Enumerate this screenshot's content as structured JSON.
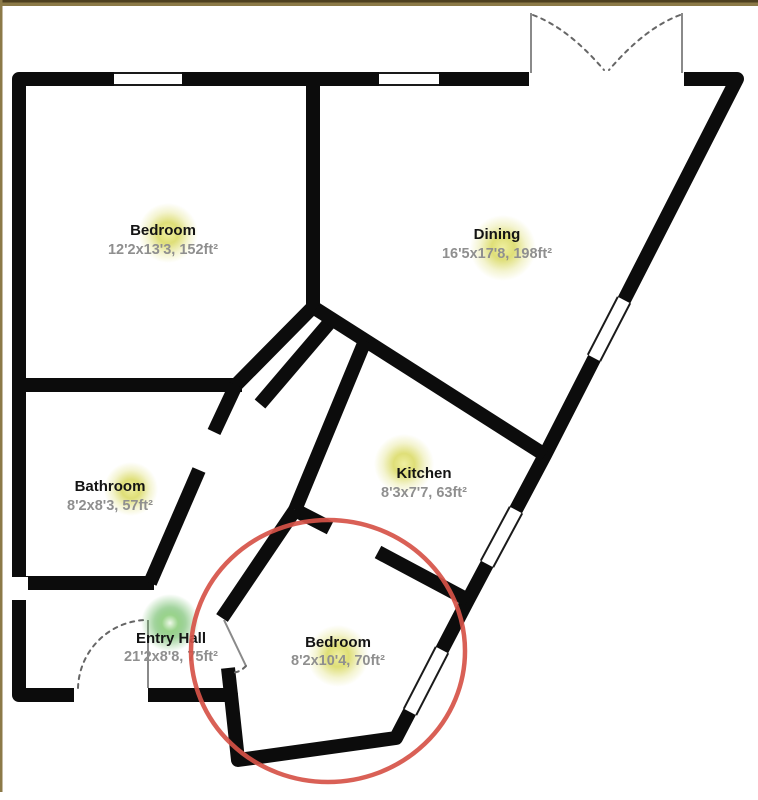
{
  "colors": {
    "wall": "#0c0c0c",
    "room_fill": "#ffffff",
    "name_text": "#141414",
    "dims_text": "#8f8f8f",
    "thin_line": "#8a8a8a",
    "dashed_line": "#666666",
    "annotation_red": "#d65348",
    "marker_yellow": "#d9d960",
    "marker_green": "#5cb354",
    "frame_brown_dark": "#4e4020",
    "frame_brown": "#8c7a48"
  },
  "rooms": [
    {
      "id": "bedroom-1",
      "name": "Bedroom",
      "dims": "12'2x13'3, 152ft²",
      "marker": "yellow"
    },
    {
      "id": "dining",
      "name": "Dining",
      "dims": "16'5x17'8, 198ft²",
      "marker": "yellow"
    },
    {
      "id": "bathroom",
      "name": "Bathroom",
      "dims": "8'2x8'3, 57ft²",
      "marker": "yellow"
    },
    {
      "id": "kitchen",
      "name": "Kitchen",
      "dims": "8'3x7'7, 63ft²",
      "marker": "yellow"
    },
    {
      "id": "entry-hall",
      "name": "Entry Hall",
      "dims": "21'2x8'8, 75ft²",
      "marker": "green"
    },
    {
      "id": "bedroom-2",
      "name": "Bedroom",
      "dims": "8'2x10'4, 70ft²",
      "marker": "yellow"
    }
  ],
  "annotations": {
    "highlight_circle_room": "bedroom-2"
  }
}
